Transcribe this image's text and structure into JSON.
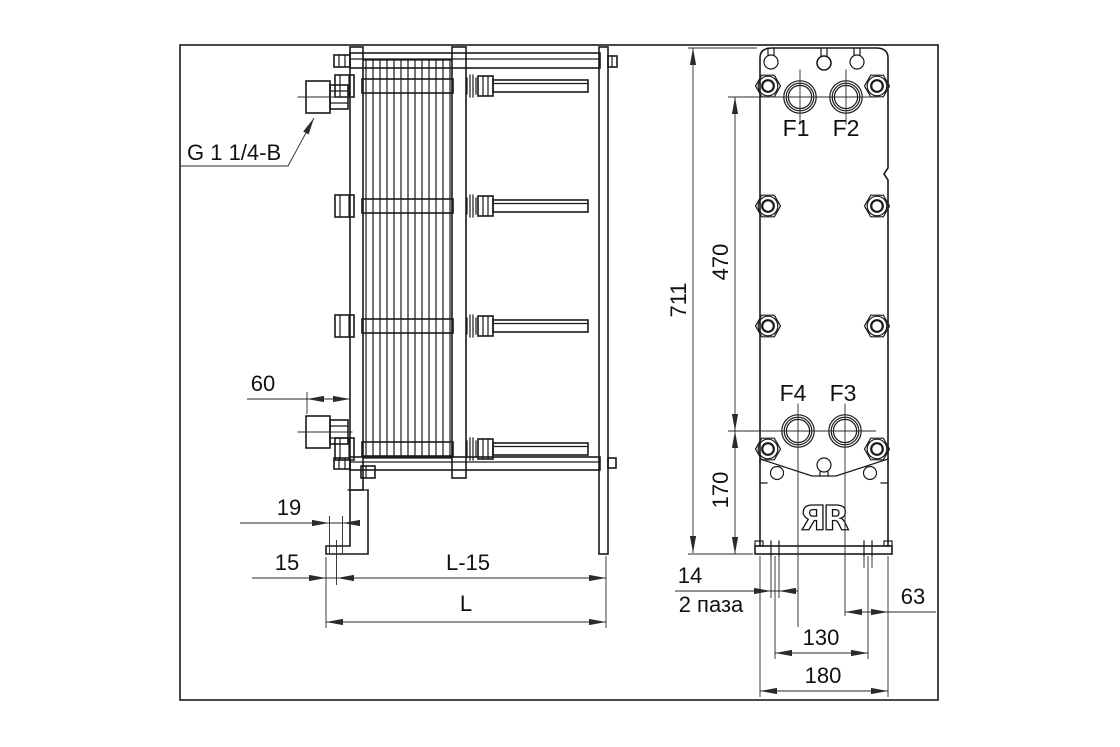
{
  "side_view": {
    "thread_label": "G 1 1/4-B",
    "dim_nozzle_protrusion": "60",
    "dim_foot_slot_length": "19",
    "dim_edge_to_slot": "15",
    "dim_frame_minus_15": "L-15",
    "dim_frame_length": "L"
  },
  "front_view": {
    "dim_total_height": "711",
    "dim_port_span_vertical": "470",
    "dim_port_to_base": "170",
    "dim_slot_width": "14",
    "slot_note": "2 паза",
    "dim_port_to_edge": "63",
    "dim_slot_spacing": "130",
    "dim_base_width": "180",
    "port_f1": "F1",
    "port_f2": "F2",
    "port_f3": "F3",
    "port_f4": "F4"
  },
  "logo": "ЯR",
  "colors": {
    "object_line": "#1a1a1a",
    "dim_line": "#2a2a2a",
    "background": "#ffffff"
  }
}
